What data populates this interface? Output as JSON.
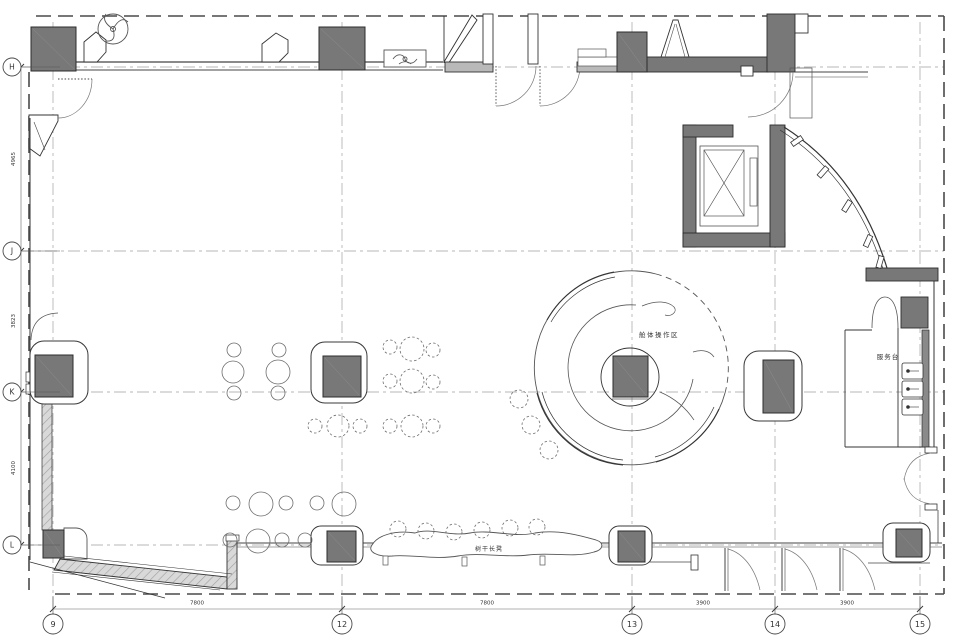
{
  "drawing": {
    "kind": "architectural-floor-plan"
  },
  "colors": {
    "wall_fill": "#787878",
    "wall_stroke": "#2c2c2c",
    "thin_line": "#444444",
    "grid_line": "#a0a0a0",
    "dash_boundary": "#4a4a4a",
    "hatch_bg": "#d9d9d9",
    "hatch_line": "#a0a0a0",
    "stool_stroke": "#6e6e6e",
    "text": "#333333",
    "background": "#ffffff"
  },
  "grid": {
    "rows": [
      {
        "label": "H",
        "y": 67
      },
      {
        "label": "J",
        "y": 251
      },
      {
        "label": "K",
        "y": 392
      },
      {
        "label": "L",
        "y": 545
      }
    ],
    "cols": [
      {
        "label": "9",
        "x": 53
      },
      {
        "label": "12",
        "x": 342
      },
      {
        "label": "13",
        "x": 632
      },
      {
        "label": "14",
        "x": 775
      },
      {
        "label": "15",
        "x": 920
      }
    ]
  },
  "dimensions": {
    "bottom": [
      {
        "text": "7800",
        "x": 197
      },
      {
        "text": "7800",
        "x": 487
      },
      {
        "text": "3900",
        "x": 703
      },
      {
        "text": "3900",
        "x": 847
      }
    ],
    "left": [
      {
        "text": "4965",
        "y": 159
      },
      {
        "text": "3823",
        "y": 321
      },
      {
        "text": "4100",
        "y": 468
      }
    ]
  },
  "labels": [
    {
      "id": "cabin-operation-area",
      "text": "舱体操作区",
      "x": 659,
      "y": 337,
      "size": 6.5,
      "spacing": 1.5
    },
    {
      "id": "tree-trunk-bench",
      "text": "树干长凳",
      "x": 489,
      "y": 551,
      "size": 6,
      "spacing": 1
    },
    {
      "id": "service-desk",
      "text": "服务台",
      "x": 888,
      "y": 359,
      "size": 6.5,
      "spacing": 1
    }
  ],
  "columns": [
    {
      "core": {
        "x": 31,
        "y": 27,
        "w": 45,
        "h": 44
      }
    },
    {
      "core": {
        "x": 319,
        "y": 27,
        "w": 46,
        "h": 43
      }
    },
    {
      "core": {
        "x": 617,
        "y": 32,
        "w": 30,
        "h": 40
      }
    },
    {
      "core": {
        "x": 35,
        "y": 355,
        "w": 38,
        "h": 42
      },
      "pad": {
        "x": 30,
        "y": 341,
        "w": 58,
        "h": 63,
        "r": 14
      }
    },
    {
      "core": {
        "x": 323,
        "y": 356,
        "w": 38,
        "h": 41
      },
      "pad": {
        "x": 311,
        "y": 342,
        "w": 56,
        "h": 61,
        "r": 14
      }
    },
    {
      "core": {
        "x": 613,
        "y": 356,
        "w": 35,
        "h": 41
      }
    },
    {
      "core": {
        "x": 763,
        "y": 360,
        "w": 31,
        "h": 53
      },
      "pad": {
        "x": 744,
        "y": 351,
        "w": 58,
        "h": 70,
        "r": 15
      }
    },
    {
      "core": {
        "x": 327,
        "y": 531,
        "w": 29,
        "h": 31
      },
      "pad": {
        "x": 311,
        "y": 526,
        "w": 52,
        "h": 39,
        "r": 10
      }
    },
    {
      "core": {
        "x": 618,
        "y": 531,
        "w": 27,
        "h": 31
      },
      "pad": {
        "x": 609,
        "y": 526,
        "w": 43,
        "h": 39,
        "r": 10
      }
    },
    {
      "core": {
        "x": 896,
        "y": 529,
        "w": 26,
        "h": 28
      },
      "pad": {
        "x": 883,
        "y": 523,
        "w": 47,
        "h": 39,
        "r": 10
      }
    },
    {
      "core": {
        "x": 43,
        "y": 530,
        "w": 21,
        "h": 28
      }
    }
  ],
  "stools": [
    {
      "cx": 234,
      "cy": 350,
      "r": 7,
      "dashed": false
    },
    {
      "cx": 279,
      "cy": 350,
      "r": 7,
      "dashed": false
    },
    {
      "cx": 233,
      "cy": 372,
      "r": 11,
      "dashed": false
    },
    {
      "cx": 278,
      "cy": 372,
      "r": 12,
      "dashed": false
    },
    {
      "cx": 234,
      "cy": 393,
      "r": 7,
      "dashed": false
    },
    {
      "cx": 278,
      "cy": 393,
      "r": 7,
      "dashed": false
    },
    {
      "cx": 390,
      "cy": 347,
      "r": 7,
      "dashed": true
    },
    {
      "cx": 412,
      "cy": 349,
      "r": 12,
      "dashed": true
    },
    {
      "cx": 433,
      "cy": 350,
      "r": 7,
      "dashed": true
    },
    {
      "cx": 390,
      "cy": 381,
      "r": 7,
      "dashed": true
    },
    {
      "cx": 412,
      "cy": 381,
      "r": 12,
      "dashed": true
    },
    {
      "cx": 433,
      "cy": 382,
      "r": 7,
      "dashed": true
    },
    {
      "cx": 315,
      "cy": 426,
      "r": 7,
      "dashed": true
    },
    {
      "cx": 338,
      "cy": 426,
      "r": 11,
      "dashed": true
    },
    {
      "cx": 360,
      "cy": 426,
      "r": 7,
      "dashed": true
    },
    {
      "cx": 390,
      "cy": 426,
      "r": 7,
      "dashed": true
    },
    {
      "cx": 412,
      "cy": 426,
      "r": 11,
      "dashed": true
    },
    {
      "cx": 433,
      "cy": 426,
      "r": 7,
      "dashed": true
    },
    {
      "cx": 519,
      "cy": 399,
      "r": 9,
      "dashed": true
    },
    {
      "cx": 531,
      "cy": 425,
      "r": 9,
      "dashed": true
    },
    {
      "cx": 549,
      "cy": 450,
      "r": 9,
      "dashed": true
    },
    {
      "cx": 233,
      "cy": 503,
      "r": 7,
      "dashed": false
    },
    {
      "cx": 261,
      "cy": 504,
      "r": 12,
      "dashed": false
    },
    {
      "cx": 286,
      "cy": 503,
      "r": 7,
      "dashed": false
    },
    {
      "cx": 230,
      "cy": 540,
      "r": 7,
      "dashed": false
    },
    {
      "cx": 258,
      "cy": 541,
      "r": 12,
      "dashed": false
    },
    {
      "cx": 282,
      "cy": 540,
      "r": 7,
      "dashed": false
    },
    {
      "cx": 317,
      "cy": 503,
      "r": 7,
      "dashed": false
    },
    {
      "cx": 344,
      "cy": 504,
      "r": 12,
      "dashed": false
    },
    {
      "cx": 305,
      "cy": 540,
      "r": 7,
      "dashed": false
    },
    {
      "cx": 398,
      "cy": 529,
      "r": 8,
      "dashed": true
    },
    {
      "cx": 426,
      "cy": 531,
      "r": 8,
      "dashed": true
    },
    {
      "cx": 454,
      "cy": 532,
      "r": 8,
      "dashed": true
    },
    {
      "cx": 482,
      "cy": 530,
      "r": 8,
      "dashed": true
    },
    {
      "cx": 510,
      "cy": 528,
      "r": 8,
      "dashed": true
    },
    {
      "cx": 537,
      "cy": 527,
      "r": 8,
      "dashed": true
    }
  ],
  "sinks": [
    {
      "x": 902,
      "y": 363
    },
    {
      "x": 902,
      "y": 381
    },
    {
      "x": 902,
      "y": 399
    }
  ],
  "bottom_doors": [
    {
      "x": 725
    },
    {
      "x": 782
    },
    {
      "x": 840
    }
  ],
  "mullions": [
    {
      "x": 797,
      "y": 141,
      "a": -35
    },
    {
      "x": 823,
      "y": 172,
      "a": -48
    },
    {
      "x": 847,
      "y": 206,
      "a": -58
    },
    {
      "x": 868,
      "y": 241,
      "a": -66
    },
    {
      "x": 880,
      "y": 262,
      "a": -74
    }
  ]
}
